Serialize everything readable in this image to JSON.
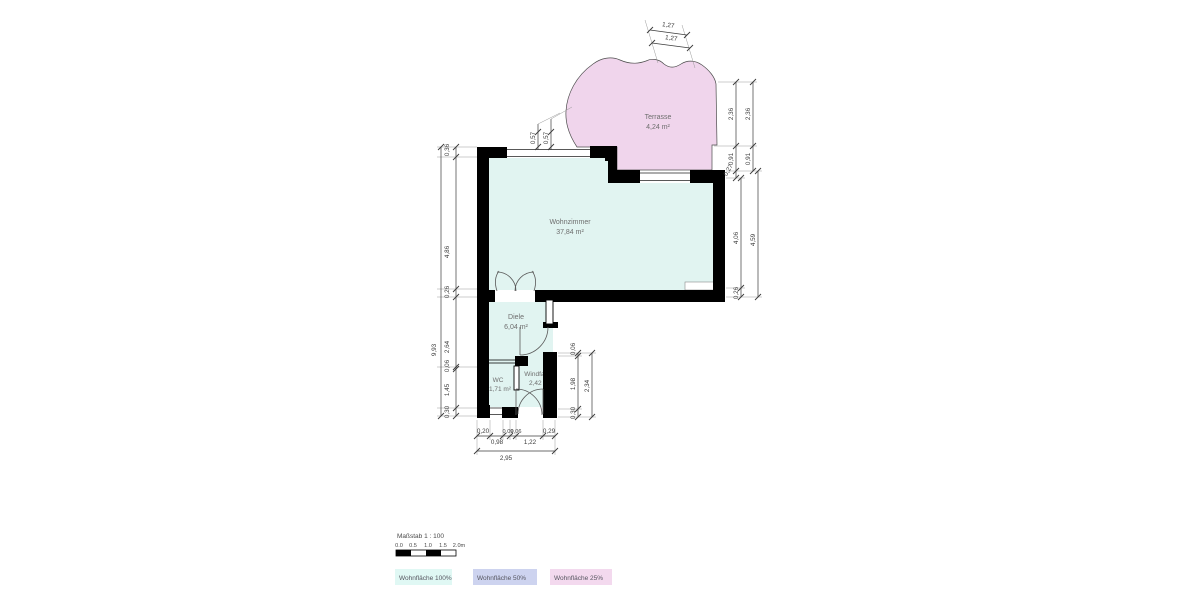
{
  "plan": {
    "type": "floorplan",
    "scale_note": "Maßstab 1 : 100"
  },
  "rooms": {
    "terrasse": {
      "name": "Terrasse",
      "area": "4,24 m²",
      "fill": "#f0d5ec"
    },
    "wohnzimmer": {
      "name": "Wohnzimmer",
      "area": "37,84 m²",
      "fill": "#e1f4f1"
    },
    "diele": {
      "name": "Diele",
      "area": "6,04 m²",
      "fill": "#e1f4f1"
    },
    "wc": {
      "name": "WC",
      "area": "1,71 m²",
      "fill": "#e1f4f1"
    },
    "windfang": {
      "name": "Windfang",
      "area": "2,42 m²",
      "fill": "#e1f4f1"
    }
  },
  "dims": {
    "top_terrace": [
      "1,27",
      "1,27"
    ],
    "upper_windows": [
      "0,57",
      "0,57"
    ],
    "left_inner": [
      "0,36",
      "4,86",
      "0,26",
      "2,64",
      "0,06",
      "1,45",
      "0,30"
    ],
    "left_total": "9,93",
    "right_terrace_inner": [
      "2,36",
      "0,91",
      "0,27"
    ],
    "right_terrace_outer": [
      "2,36",
      "0,91"
    ],
    "right_room_inner": [
      "4,06",
      "0,26"
    ],
    "right_room_total": "4,59",
    "windfang_inner": [
      "0,06",
      "1,98",
      "0,30"
    ],
    "windfang_total": "2,34",
    "bottom_inner": [
      "0,20",
      "0,98",
      "0,09",
      "0,06",
      "1,22",
      "0,29"
    ],
    "bottom_total": "2,95"
  },
  "scalebar": {
    "title": "Maßstab 1 : 100",
    "ticks": [
      "0.0",
      "0.5",
      "1.0",
      "1.5",
      "2.0m"
    ]
  },
  "legend": [
    {
      "label": "Wohnfläche 100%",
      "color": "#e0f8f4"
    },
    {
      "label": "Wohnfläche 50%",
      "color": "#cdd3ef"
    },
    {
      "label": "Wohnfläche 25%",
      "color": "#f3d9ee"
    }
  ],
  "colors": {
    "wall": "#000000",
    "dim_line": "#3c3c3c",
    "extension_line": "#9a9a9a",
    "door_arc": "#5a5a5a",
    "outline": "#4d4d4d"
  }
}
